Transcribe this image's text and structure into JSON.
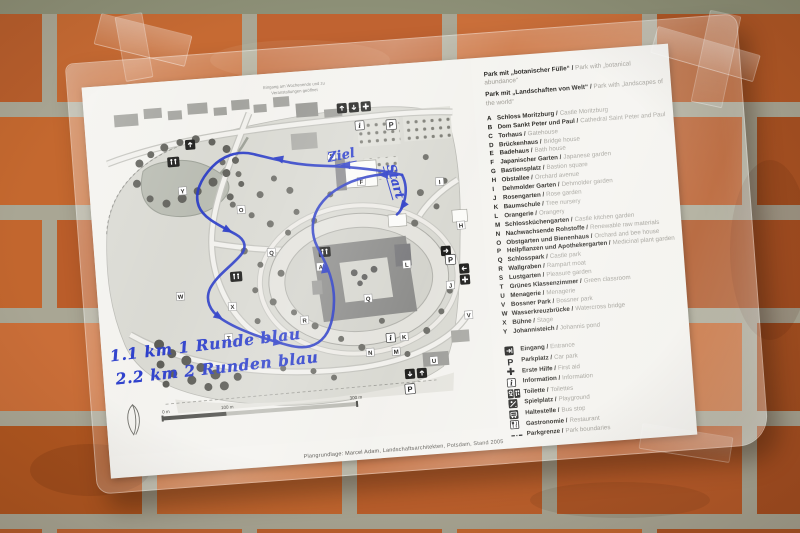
{
  "map": {
    "note_line1": "Eingang am Wochenende und zu",
    "note_line2": "Veranstaltungen geöffnet",
    "handwriting": {
      "ziel": "Ziel",
      "start": "Start",
      "line1": "1.1 km  1 Runde blau",
      "line2": "2.2 km  2 Runden blau"
    },
    "route_color": "#2133c4",
    "labels": [
      "A",
      "F",
      "H",
      "I",
      "J",
      "K",
      "L",
      "M",
      "N",
      "O",
      "Q",
      "Q",
      "R",
      "S",
      "T",
      "U",
      "V",
      "W",
      "X",
      "Y"
    ],
    "icons": {
      "parking": "P",
      "info": "i"
    },
    "scale": {
      "t0": "0 m",
      "t100": "100 m",
      "t300": "300 m"
    },
    "caption": "Plangrundlage: Marcel Adam, Landschaftsarchitekten, Potsdam, Stand 2005"
  },
  "legend": {
    "header1_de": "Park mit „botanischer Fülle“ /",
    "header1_en": "Park with „botanical abundance“",
    "header2_de": "Park mit „Landschaften von Welt“ /",
    "header2_en": "Park with „landscapes of the world“",
    "items": [
      {
        "letter": "A",
        "de": "Schloss Moritzburg /",
        "en": "Castle Moritzburg"
      },
      {
        "letter": "B",
        "de": "Dom Sankt Peter und Paul /",
        "en": "Cathedral Saint Peter and Paul"
      },
      {
        "letter": "C",
        "de": "Torhaus /",
        "en": "Gatehouse"
      },
      {
        "letter": "D",
        "de": "Brückenhaus /",
        "en": "Bridge house"
      },
      {
        "letter": "E",
        "de": "Badehaus /",
        "en": "Bath house"
      },
      {
        "letter": "F",
        "de": "Japanischer Garten /",
        "en": "Japanese garden"
      },
      {
        "letter": "G",
        "de": "Bastionsplatz /",
        "en": "Bastion square"
      },
      {
        "letter": "H",
        "de": "Obstallee /",
        "en": "Orchard avenue"
      },
      {
        "letter": "I",
        "de": "Dehmolder Garten /",
        "en": "Dehmolder garden"
      },
      {
        "letter": "J",
        "de": "Rosengarten /",
        "en": "Rose garden"
      },
      {
        "letter": "K",
        "de": "Baumschule /",
        "en": "Tree nursery"
      },
      {
        "letter": "L",
        "de": "Orangerie /",
        "en": "Orangery"
      },
      {
        "letter": "M",
        "de": "Schlossküchengarten /",
        "en": "Castle kitchen garden"
      },
      {
        "letter": "N",
        "de": "Nachwachsende Rohstoffe /",
        "en": "Renewable raw materials"
      },
      {
        "letter": "O",
        "de": "Obstgarten und Bienenhaus /",
        "en": "Orchard and bee house"
      },
      {
        "letter": "P",
        "de": "Heilpflanzen und Apothekergarten /",
        "en": "Medicinal plant garden"
      },
      {
        "letter": "Q",
        "de": "Schlosspark /",
        "en": "Castle park"
      },
      {
        "letter": "R",
        "de": "Wallgraben /",
        "en": "Rampart moat"
      },
      {
        "letter": "S",
        "de": "Lustgarten /",
        "en": "Pleasure garden"
      },
      {
        "letter": "T",
        "de": "Grünes Klassenzimmer /",
        "en": "Green classroom"
      },
      {
        "letter": "U",
        "de": "Menagerie /",
        "en": "Menagerie"
      },
      {
        "letter": "V",
        "de": "Bossner Park /",
        "en": "Bossner park"
      },
      {
        "letter": "W",
        "de": "Wasserkreuzbrücke /",
        "en": "Watercross bridge"
      },
      {
        "letter": "X",
        "de": "Bühne /",
        "en": "Stage"
      },
      {
        "letter": "Y",
        "de": "Johannisteich /",
        "en": "Johannis pond"
      }
    ],
    "facilities": [
      {
        "de": "Eingang /",
        "en": "Entrance"
      },
      {
        "de": "Parkplatz /",
        "en": "Car park",
        "glyph": "P"
      },
      {
        "de": "Erste Hilfe /",
        "en": "First aid"
      },
      {
        "de": "Information /",
        "en": "Information",
        "glyph": "i"
      },
      {
        "de": "Toilette /",
        "en": "Toilettes"
      },
      {
        "de": "Spielplatz /",
        "en": "Playground"
      },
      {
        "de": "Haltestelle /",
        "en": "Bus stop"
      },
      {
        "de": "Gastronomie /",
        "en": "Restaurant"
      },
      {
        "de": "Parkgrenze /",
        "en": "Park boundaries"
      }
    ]
  }
}
